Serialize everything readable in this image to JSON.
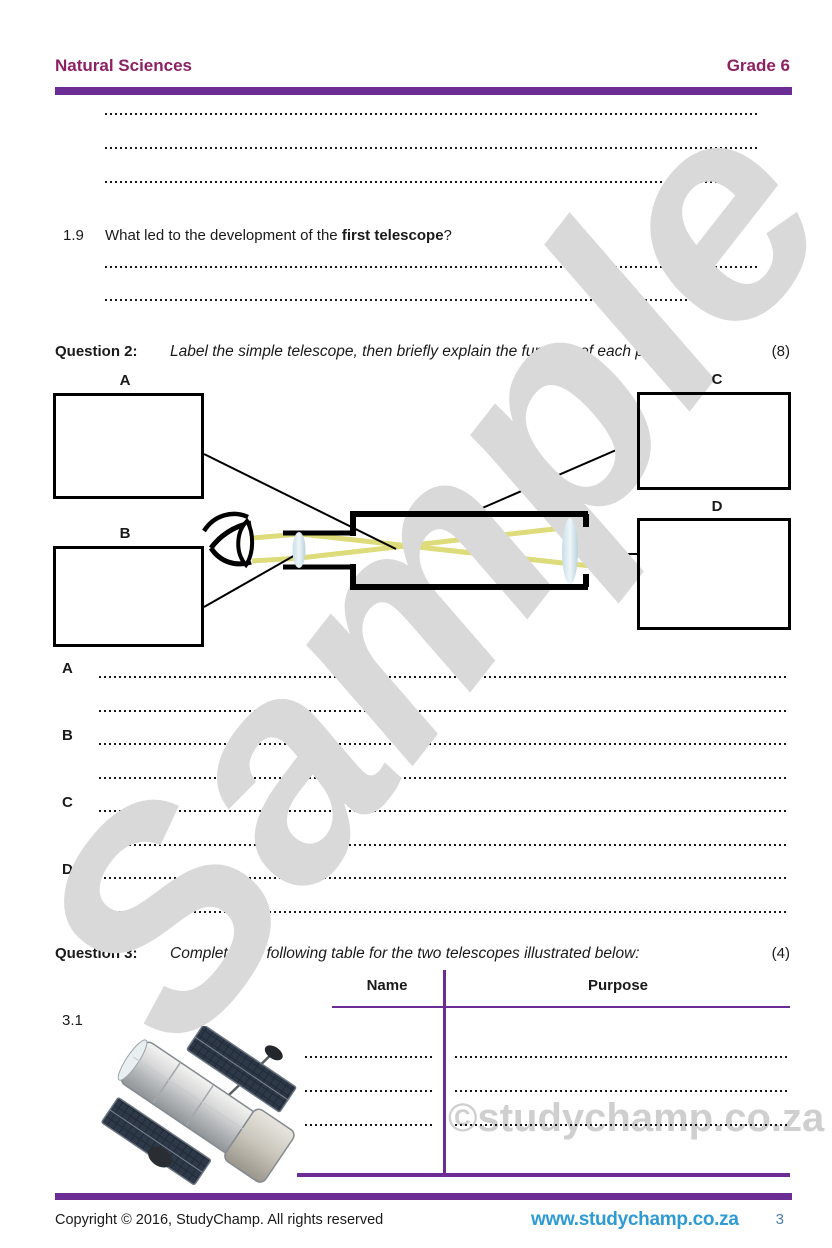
{
  "header": {
    "subject": "Natural Sciences",
    "grade": "Grade 6"
  },
  "q19": {
    "number": "1.9",
    "text_prefix": "What led to the development of the ",
    "text_bold": "first telescope",
    "text_suffix": "?",
    "marks": "(1)"
  },
  "q2": {
    "label": "Question 2:",
    "instruction": "Label the simple telescope, then briefly explain the function of each part:",
    "marks": "(8)"
  },
  "diagram": {
    "label_a": "A",
    "label_b": "B",
    "label_c": "C",
    "label_d": "D",
    "parts": [
      "label-box-a",
      "label-box-b",
      "label-box-c",
      "label-box-d",
      "eye-icon",
      "eyepiece-lens",
      "telescope-tube",
      "objective-lens",
      "light-rays"
    ]
  },
  "answers": [
    "A",
    "B",
    "C",
    "D"
  ],
  "q3": {
    "label": "Question 3:",
    "instruction": "Complete the following table for the two telescopes illustrated below:",
    "marks": "(4)"
  },
  "table": {
    "columns": [
      "Name",
      "Purpose"
    ],
    "rows": [
      {
        "number": "3.1",
        "image": "hubble-space-telescope"
      }
    ]
  },
  "watermarks": {
    "diagonal": "Sample",
    "site": "©studychamp.co.za"
  },
  "footer": {
    "copyright": "Copyright © 2016, StudyChamp. All rights reserved",
    "website": "www.studychamp.co.za",
    "page": "3"
  },
  "colors": {
    "accent_purple": "#6b2d94",
    "brand_maroon": "#8e2163",
    "link_blue": "#2e9bd5",
    "ray_yellow": "#dedb7a",
    "watermark_gray": "#d9d9d9"
  }
}
